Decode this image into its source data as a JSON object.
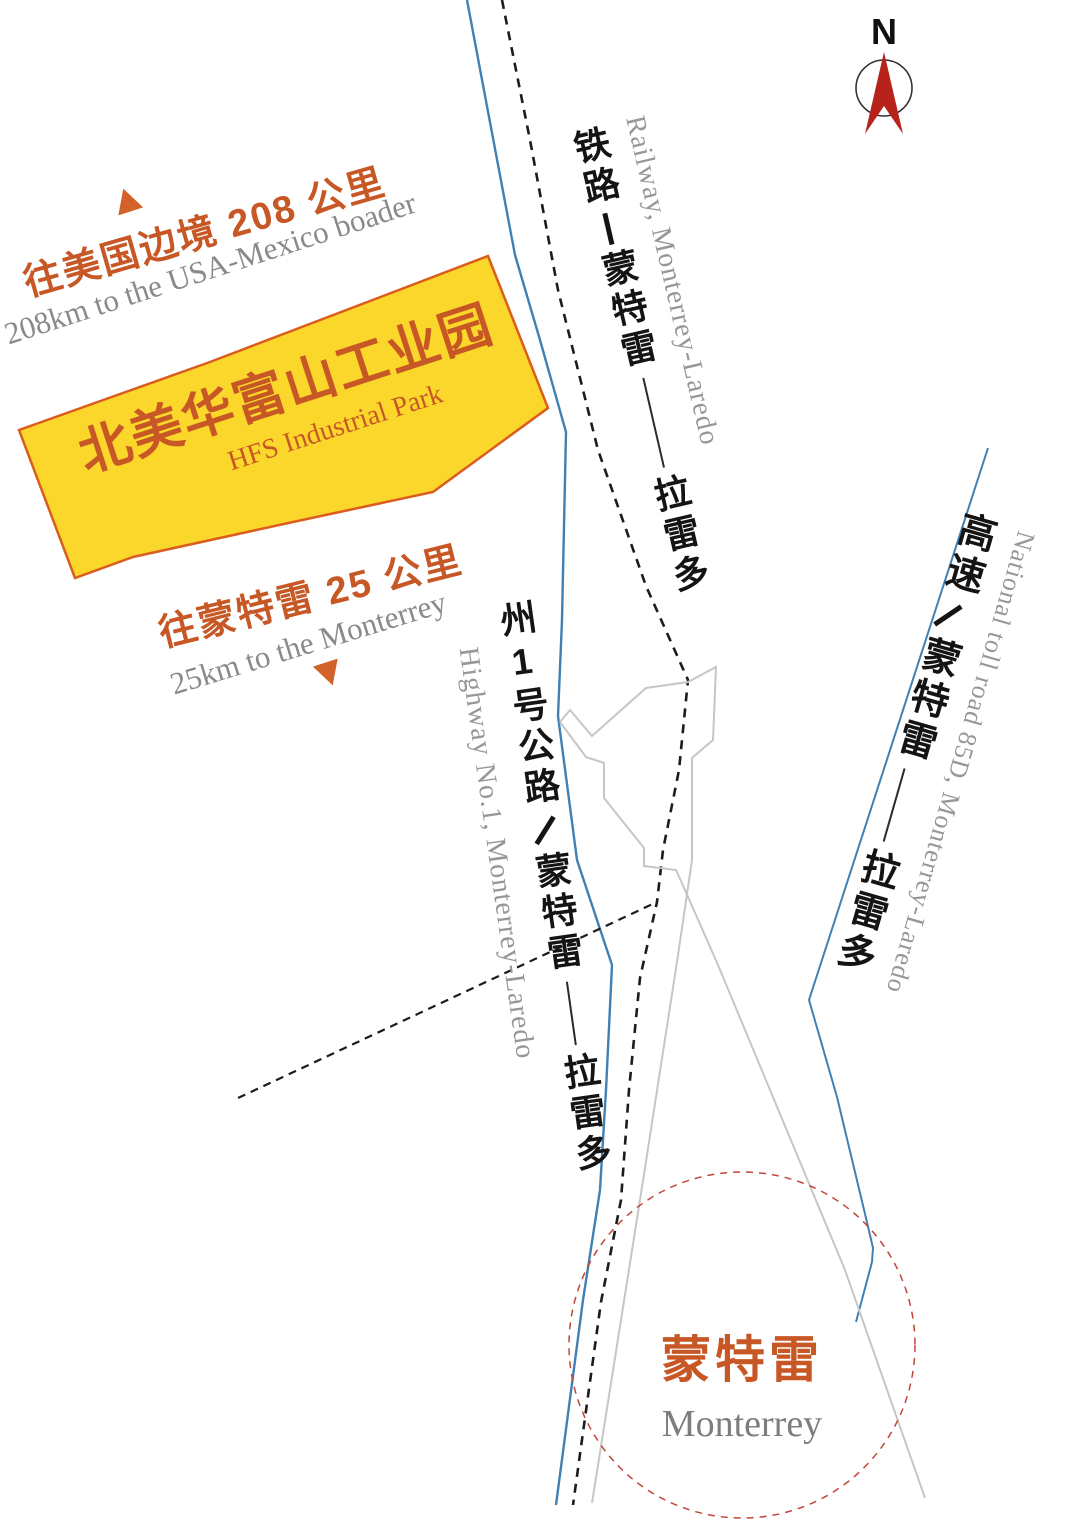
{
  "colors": {
    "accent": "#c75826",
    "parkYellow": "#fcd72b",
    "parkBorder": "#da5d1d",
    "blueRoad": "#4080b2",
    "railColor": "#1c1c1c",
    "streetGray": "#c6c6c6",
    "circleRed": "#c2453a",
    "compassRed": "#b7221a",
    "triOrange": "#d2622a"
  },
  "compass": {
    "label": "N"
  },
  "annotations": {
    "border": {
      "zh": "往美国边境 208 公里",
      "en": "208km to the USA-Mexico boader"
    },
    "monterrey_distance": {
      "zh": "往蒙特雷 25 公里",
      "en": "25km to the Monterrey"
    }
  },
  "park": {
    "zh": "北美华富山工业园",
    "en": "HFS Industrial Park"
  },
  "routes": {
    "railway": {
      "zh_type": "铁路",
      "zh_via": "蒙特雷",
      "zh_to": "拉雷多",
      "en": "Railway, Monterrey-Laredo"
    },
    "highway": {
      "zh_type": "州1号公路",
      "zh_via": "蒙特雷",
      "zh_to": "拉雷多",
      "en": "Highway No.1, Monterrey-Laredo"
    },
    "toll_road": {
      "zh_type": "高速",
      "zh_via": "蒙特雷",
      "zh_to": "拉雷多",
      "en": "National toll road 85D, Monterrey-Laredo"
    }
  },
  "city": {
    "zh": "蒙特雷",
    "en": "Monterrey"
  }
}
